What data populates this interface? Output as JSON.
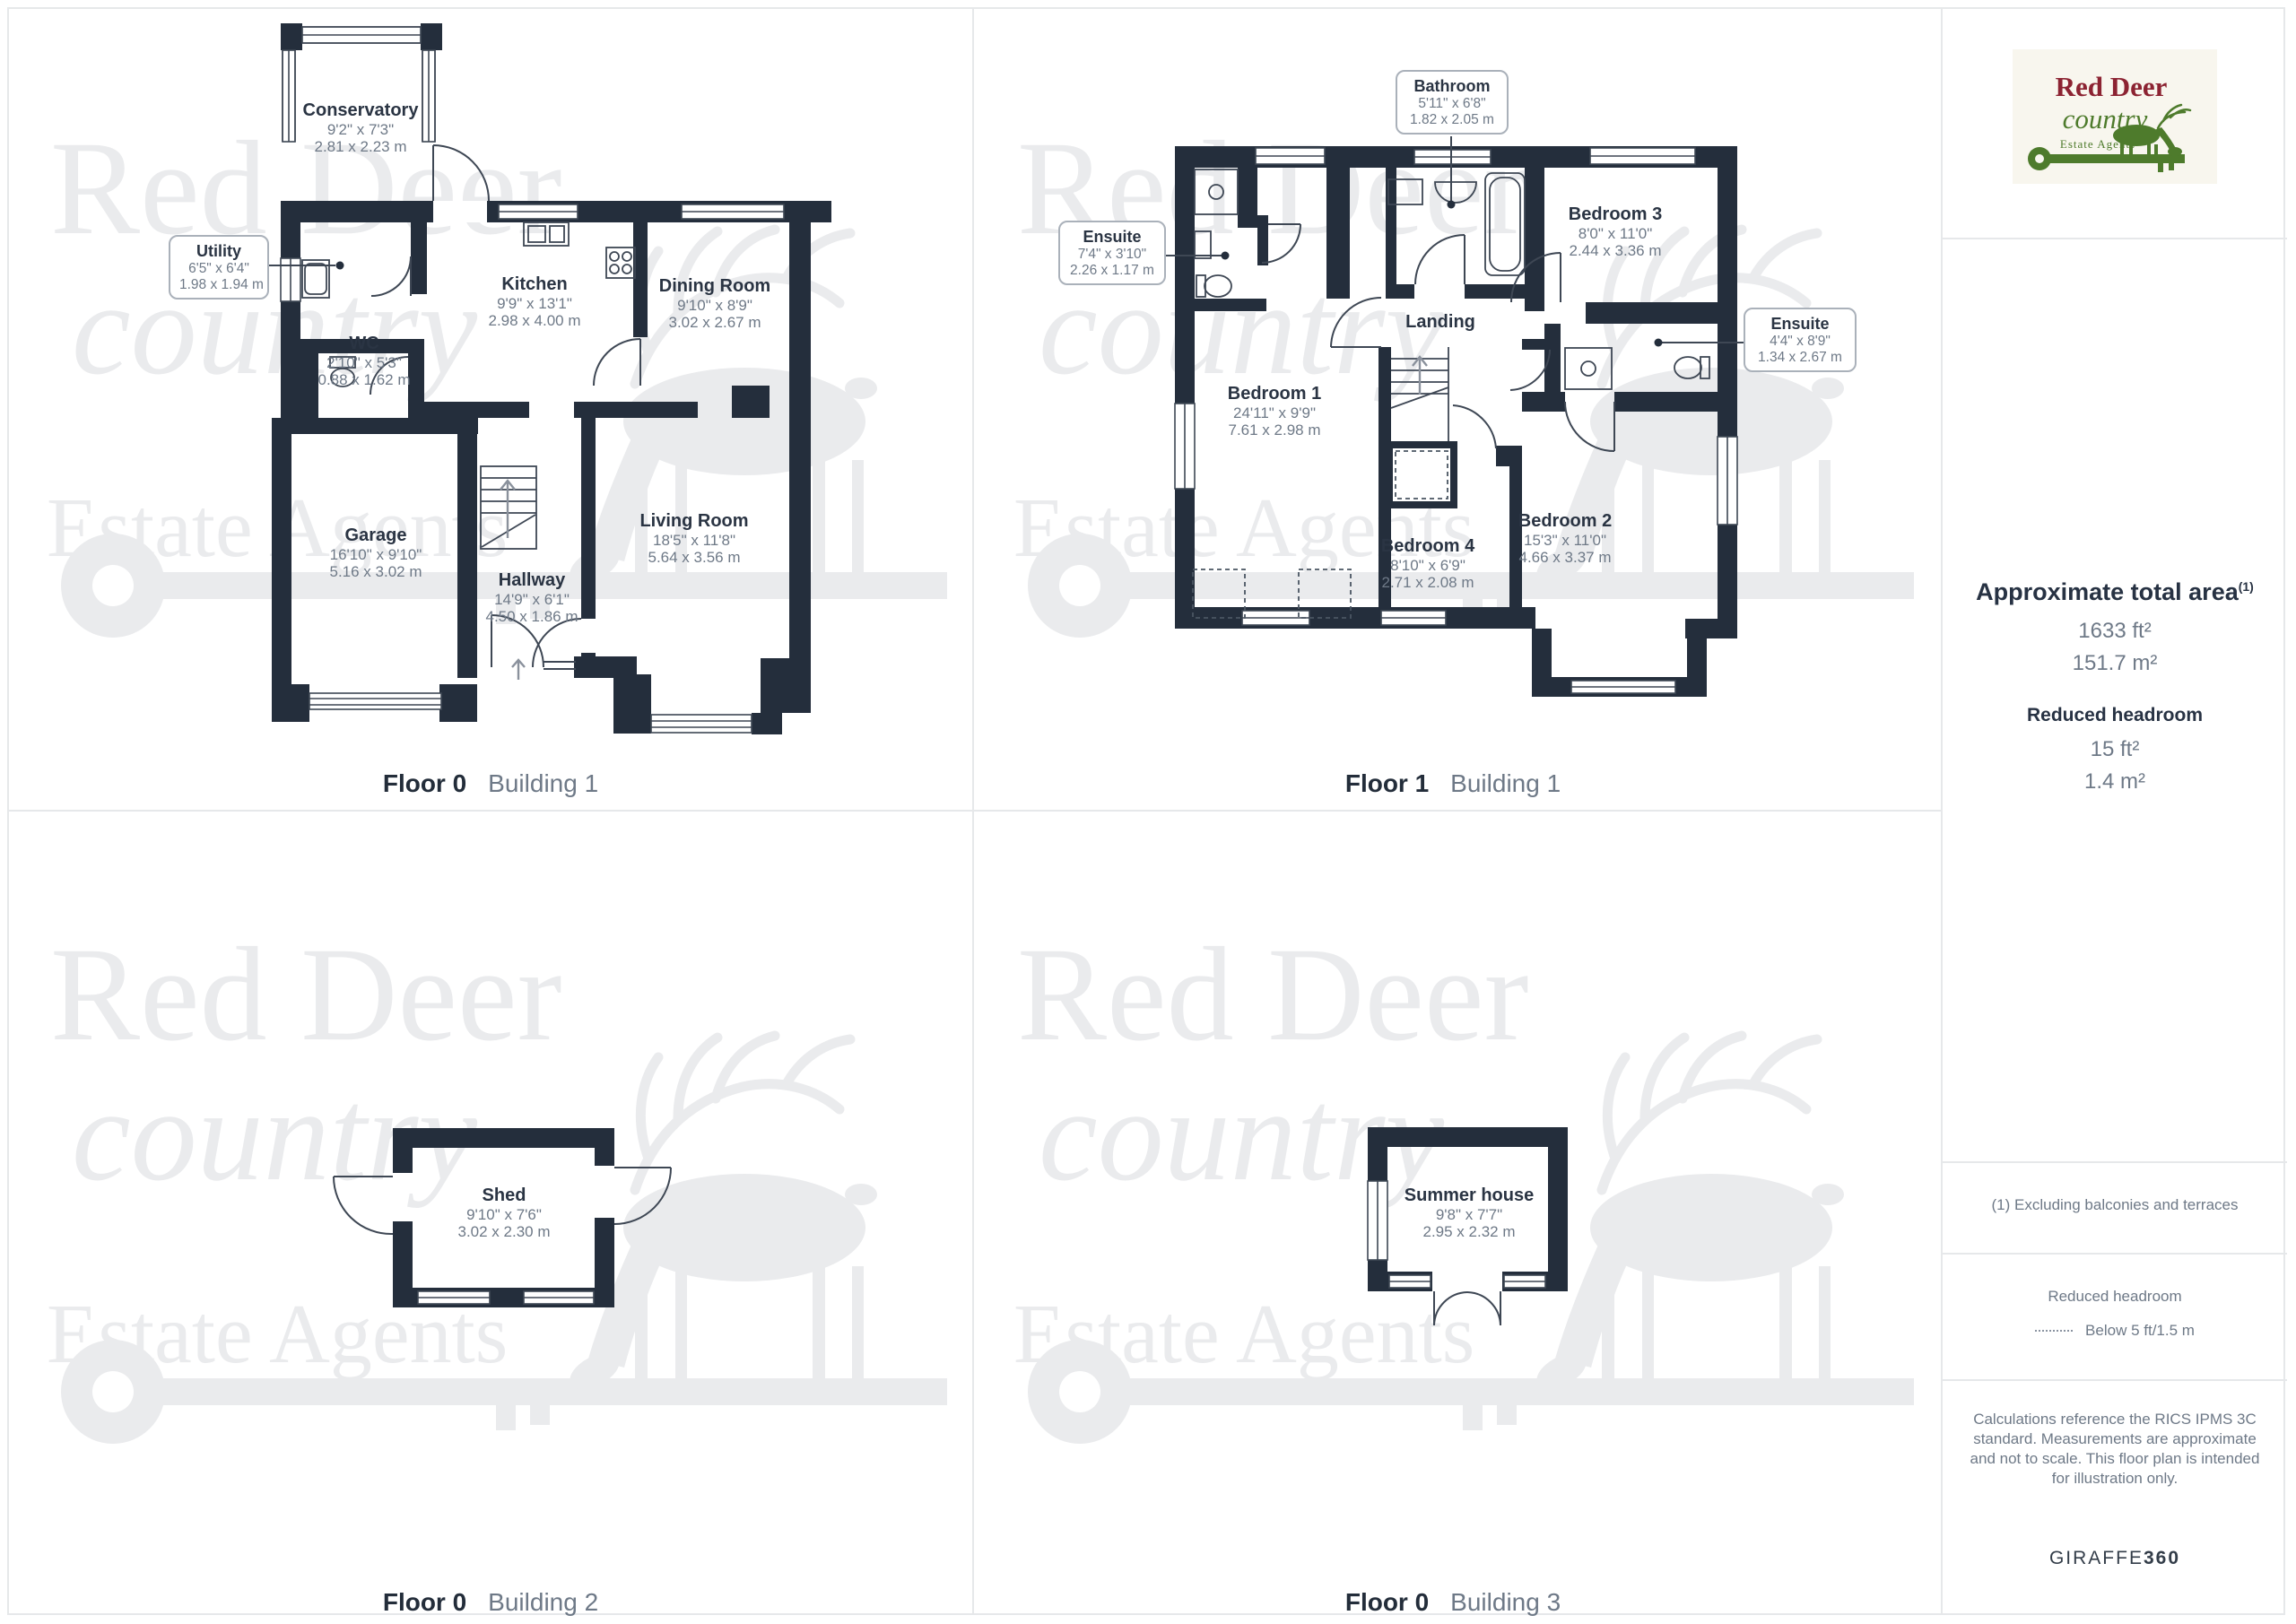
{
  "captions": {
    "tl": {
      "floor": "Floor 0",
      "building": "Building 1"
    },
    "tr": {
      "floor": "Floor 1",
      "building": "Building 1"
    },
    "bl": {
      "floor": "Floor 0",
      "building": "Building 2"
    },
    "br": {
      "floor": "Floor 0",
      "building": "Building 3"
    }
  },
  "rooms": {
    "conservatory": {
      "name": "Conservatory",
      "imperial": "9'2\" x 7'3\"",
      "metric": "2.81 x 2.23 m"
    },
    "utility": {
      "name": "Utility",
      "imperial": "6'5\" x 6'4\"",
      "metric": "1.98 x 1.94 m"
    },
    "kitchen": {
      "name": "Kitchen",
      "imperial": "9'9\" x 13'1\"",
      "metric": "2.98 x 4.00 m"
    },
    "dining": {
      "name": "Dining Room",
      "imperial": "9'10\" x 8'9\"",
      "metric": "3.02 x 2.67 m"
    },
    "wc": {
      "name": "WC",
      "imperial": "2'10\" x 5'3\"",
      "metric": "0.88 x 1.62 m"
    },
    "garage": {
      "name": "Garage",
      "imperial": "16'10\" x 9'10\"",
      "metric": "5.16 x 3.02 m"
    },
    "hallway": {
      "name": "Hallway",
      "imperial": "14'9\" x 6'1\"",
      "metric": "4.50 x 1.86 m"
    },
    "living": {
      "name": "Living Room",
      "imperial": "18'5\" x 11'8\"",
      "metric": "5.64 x 3.56 m"
    },
    "ensuite1": {
      "name": "Ensuite",
      "imperial": "7'4\" x 3'10\"",
      "metric": "2.26 x 1.17 m"
    },
    "bathroom": {
      "name": "Bathroom",
      "imperial": "5'11\" x 6'8\"",
      "metric": "1.82 x 2.05 m"
    },
    "bedroom3": {
      "name": "Bedroom 3",
      "imperial": "8'0\" x 11'0\"",
      "metric": "2.44 x 3.36 m"
    },
    "ensuite2": {
      "name": "Ensuite",
      "imperial": "4'4\" x 8'9\"",
      "metric": "1.34 x 2.67 m"
    },
    "landing": {
      "name": "Landing"
    },
    "bedroom1": {
      "name": "Bedroom 1",
      "imperial": "24'11\" x 9'9\"",
      "metric": "7.61 x 2.98 m"
    },
    "bedroom4": {
      "name": "Bedroom 4",
      "imperial": "8'10\" x 6'9\"",
      "metric": "2.71 x 2.08 m"
    },
    "bedroom2": {
      "name": "Bedroom 2",
      "imperial": "15'3\" x 11'0\"",
      "metric": "4.66 x 3.37 m"
    },
    "shed": {
      "name": "Shed",
      "imperial": "9'10\" x 7'6\"",
      "metric": "3.02 x 2.30 m"
    },
    "summerhouse": {
      "name": "Summer house",
      "imperial": "9'8\" x 7'7\"",
      "metric": "2.95 x 2.32 m"
    }
  },
  "watermark": {
    "line1": "Red Deer",
    "line2": "country",
    "line3": "Estate Agents"
  },
  "logo": {
    "line1": "Red Deer",
    "line2": "country",
    "line3": "Estate Agents"
  },
  "sidebar": {
    "area_title": "Approximate total area",
    "area_superscript": "(1)",
    "area_imperial": "1633 ft²",
    "area_metric": "151.7 m²",
    "reduced_title": "Reduced headroom",
    "reduced_imperial": "15 ft²",
    "reduced_metric": "1.4 m²",
    "footnote": "(1) Excluding balconies and terraces",
    "legend_title": "Reduced headroom",
    "legend_label": "Below 5 ft/1.5 m",
    "disclaimer": "Calculations reference the RICS IPMS 3C standard. Measurements are approximate and not to scale. This floor plan is intended for illustration only.",
    "brand_name": "GIRAFFE",
    "brand_number": "360"
  },
  "colors": {
    "wall": "#242e3c",
    "line": "#3e4754",
    "room_name": "#2a3443",
    "dimension": "#6e7987",
    "watermark": "#eaebed",
    "divider": "#e6e8ea",
    "logo_red": "#8c2332",
    "logo_green": "#4e7b2c"
  }
}
